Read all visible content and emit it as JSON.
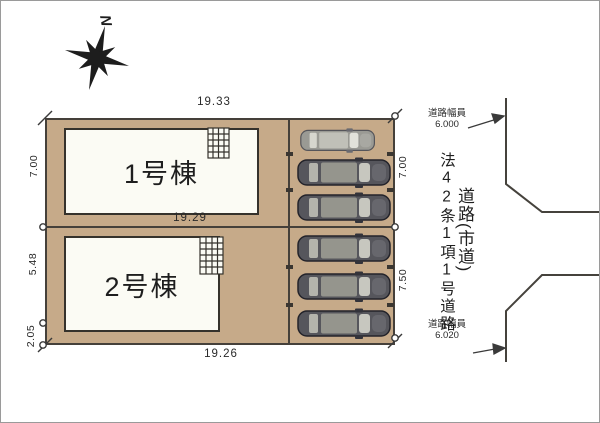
{
  "compass": {
    "north_label": "N"
  },
  "site": {
    "lot1_label": "1号棟",
    "lot2_label": "2号棟"
  },
  "dimensions": {
    "top_edge": "19.33",
    "middle_edge": "19.29",
    "bottom_edge": "19.26",
    "left_upper": "7.00",
    "left_middle": "5.48",
    "left_lower": "2.05",
    "right_upper": "7.00",
    "right_lower": "7.50"
  },
  "road": {
    "width_top_label": "道路幅員",
    "width_top_value": "6.000",
    "width_bottom_label": "道路幅員",
    "width_bottom_value": "6.020",
    "legal_designation": "法42条1項1号道路",
    "type_label": "道路(市道)"
  },
  "parking": {
    "car_count": 6
  },
  "colors": {
    "plot_fill": "#c6aa89",
    "line": "#45403a",
    "building_fill": "#fbfbf4",
    "car_body": "#56565c",
    "car_body_light": "#9a9a94"
  }
}
